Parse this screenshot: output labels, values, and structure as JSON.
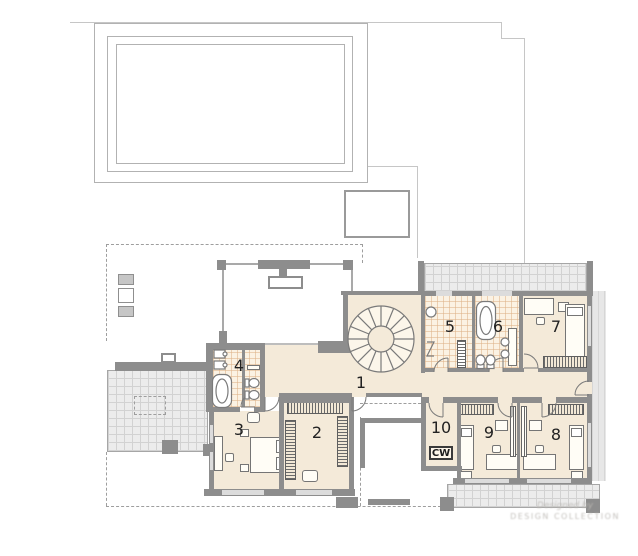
{
  "plan": {
    "floor_label_rooms": [
      {
        "label": "1"
      },
      {
        "label": "2"
      },
      {
        "label": "3"
      },
      {
        "label": "4"
      },
      {
        "label": "5"
      },
      {
        "label": "6"
      },
      {
        "label": "7"
      },
      {
        "label": "8"
      },
      {
        "label": "9"
      },
      {
        "label": "10"
      }
    ],
    "utility_label": "CW",
    "watermark": {
      "line1": "Designed by",
      "line2": "DESIGN COLLECTION"
    },
    "palette": {
      "wall": "#8d8d8d",
      "room_fill": "#f4ead9",
      "bath_tile_fill": "#fbf2e3",
      "bath_tile_line": "#deb288",
      "terrace_fill": "#ececec",
      "terrace_grid": "#d2d2d2",
      "site_outline": "#b2b2b2",
      "dashed_line": "#9e9e9e",
      "label_color": "#222222"
    },
    "symbols": {
      "stair": "spiral-staircase-icon",
      "bathtub": "bathtub-icon",
      "toilet": "toilet-icon",
      "sink": "sink-icon",
      "bed": "bed-icon",
      "wardrobe": "wardrobe-shelving-icon",
      "radiator": "radiator-icon",
      "door": "door-swing-icon",
      "pool": "swimming-pool-outline",
      "terrace": "terrace-hatch",
      "balcony": "balcony-hatch"
    }
  }
}
